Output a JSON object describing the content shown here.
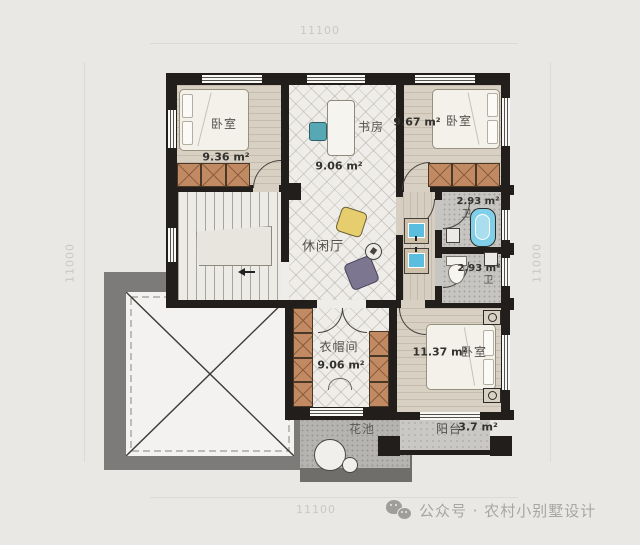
{
  "dimensions": {
    "top": "11100",
    "bottom": "11100",
    "left": "11000",
    "right": "11000"
  },
  "rooms": {
    "bedroom_top_left": {
      "name": "卧室",
      "area": "9.36 m²"
    },
    "study": {
      "name": "书房",
      "area": "9.06 m²"
    },
    "bedroom_top_right": {
      "name": "卧室",
      "area": "9.67 m²"
    },
    "leisure_hall": {
      "name": "休闲厅"
    },
    "bathroom_upper": {
      "name": "卫",
      "area": "2.93 m²"
    },
    "bathroom_lower": {
      "name": "卫",
      "area": "2.93 m²"
    },
    "cloakroom": {
      "name": "衣帽间",
      "area": "9.06 m²"
    },
    "bedroom_bottom_right": {
      "name": "卧室",
      "area": "11.37 m²"
    },
    "flower_bed": {
      "name": "花池"
    },
    "balcony": {
      "name": "阳台",
      "area": "3.7 m²"
    }
  },
  "watermark": {
    "label": "公众号 · 农村小别墅设计",
    "icon": "wechat-icon"
  },
  "colors": {
    "wall": "#211e1b",
    "wood_floor": "#d9d0c4",
    "tile_floor": "#efede9",
    "wardrobe": "#c28a62",
    "fixture_blue": "#5bbede",
    "roof_gray": "#7c7b79",
    "bean_bag_yellow": "#e6cd6d",
    "bean_bag_purple": "#7d7691"
  }
}
